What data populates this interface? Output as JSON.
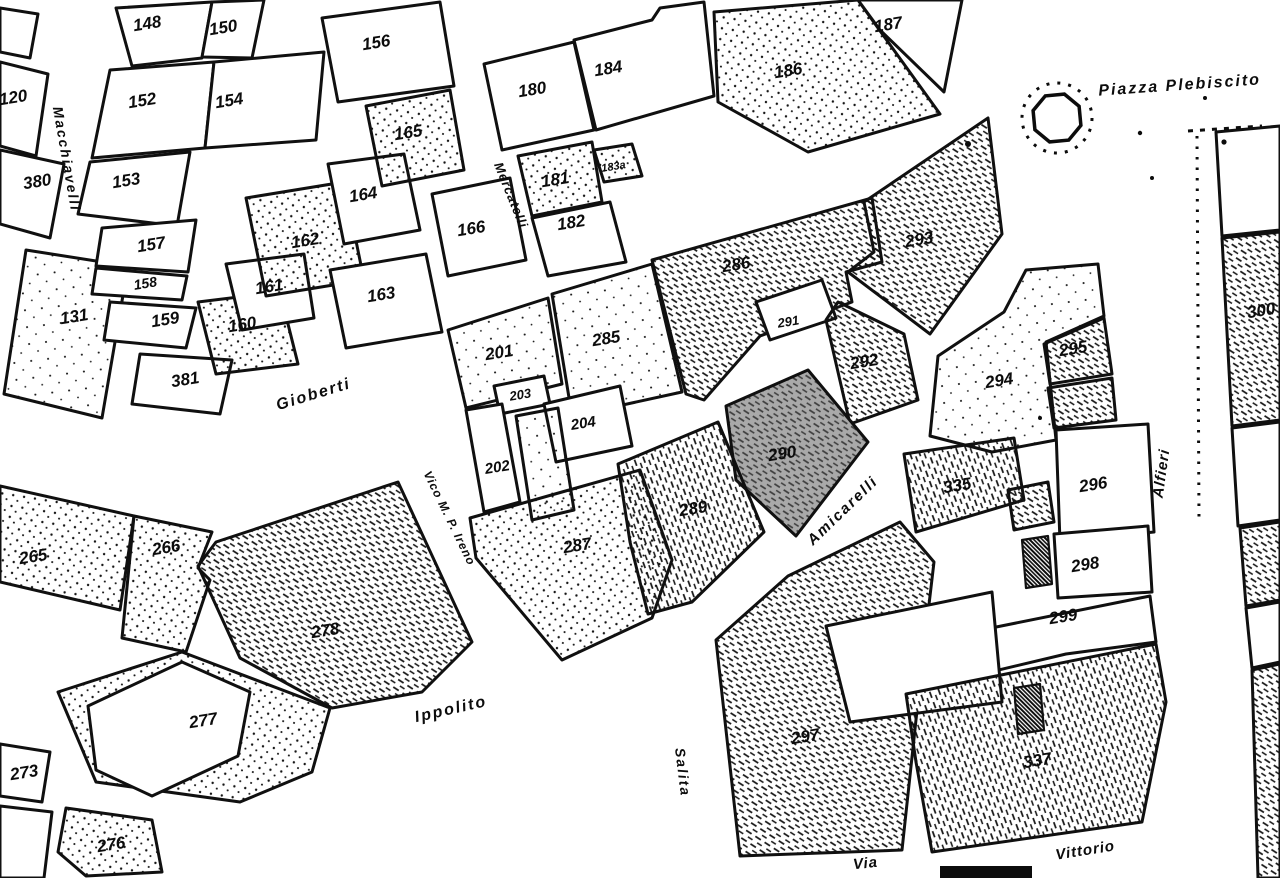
{
  "map": {
    "ink": "#0c0c0c",
    "paper": "#ffffff",
    "highlight_fill": "#a9a9a9",
    "streets": [
      {
        "name": "Macchiavelli",
        "x": 62,
        "y": 160,
        "rotate": 80,
        "size": 14,
        "spacing": 2
      },
      {
        "name": "Mercatelli",
        "x": 507,
        "y": 197,
        "rotate": 68,
        "size": 13,
        "spacing": 1
      },
      {
        "name": "Gioberti",
        "x": 315,
        "y": 399,
        "rotate": -17,
        "size": 16,
        "spacing": 2
      },
      {
        "name": "Vico M. P. Ireno",
        "x": 446,
        "y": 520,
        "rotate": 64,
        "size": 12,
        "spacing": 1
      },
      {
        "name": "Ippolito",
        "x": 452,
        "y": 714,
        "rotate": -13,
        "size": 16,
        "spacing": 2
      },
      {
        "name": "Salita",
        "x": 678,
        "y": 773,
        "rotate": 83,
        "size": 14,
        "spacing": 2
      },
      {
        "name": "Amicarelli",
        "x": 846,
        "y": 514,
        "rotate": -44,
        "size": 15,
        "spacing": 2
      },
      {
        "name": "Alfieri",
        "x": 1166,
        "y": 474,
        "rotate": -82,
        "size": 15,
        "spacing": 1
      },
      {
        "name": "Piazza Plebiscito",
        "x": 1180,
        "y": 90,
        "rotate": -4,
        "size": 16,
        "spacing": 2
      },
      {
        "name": "Via",
        "x": 866,
        "y": 868,
        "rotate": -6,
        "size": 15,
        "spacing": 1
      },
      {
        "name": "Vittorio",
        "x": 1086,
        "y": 855,
        "rotate": -9,
        "size": 15,
        "spacing": 1
      }
    ],
    "parcels": [
      {
        "number": "120",
        "x": 14,
        "y": 103,
        "fill": "white",
        "points": "0,62 48,74 36,156 0,146"
      },
      {
        "number": "380",
        "x": 38,
        "y": 187,
        "fill": "white",
        "points": "0,150 64,164 50,238 0,224"
      },
      {
        "number": "131",
        "x": 75,
        "y": 322,
        "fill": "dots2",
        "points": "26,250 128,266 102,418 4,394"
      },
      {
        "number": "",
        "x": 0,
        "y": 0,
        "fill": "white",
        "points": "0,8 38,14 30,58 0,52"
      },
      {
        "number": "148",
        "x": 148,
        "y": 29,
        "fill": "white",
        "points": "116,8 212,2 202,58 132,66"
      },
      {
        "number": "150",
        "x": 224,
        "y": 33,
        "fill": "white",
        "points": "212,2 264,0 252,58 202,57"
      },
      {
        "number": "152",
        "x": 143,
        "y": 106,
        "fill": "white",
        "points": "110,70 214,62 205,148 92,158"
      },
      {
        "number": "154",
        "x": 230,
        "y": 106,
        "fill": "white",
        "points": "214,62 324,52 316,140 205,148"
      },
      {
        "number": "156",
        "x": 377,
        "y": 48,
        "fill": "white",
        "points": "322,18 440,2 454,86 338,102"
      },
      {
        "number": "153",
        "x": 127,
        "y": 186,
        "fill": "white",
        "points": "90,162 190,152 177,226 78,214"
      },
      {
        "number": "157",
        "x": 152,
        "y": 250,
        "fill": "white",
        "points": "102,228 196,220 188,272 96,266"
      },
      {
        "number": "158",
        "x": 146,
        "y": 288,
        "fill": "white",
        "size": 14,
        "points": "96,268 187,276 182,300 92,294"
      },
      {
        "number": "159",
        "x": 166,
        "y": 325,
        "fill": "white",
        "points": "110,302 196,308 186,348 104,340"
      },
      {
        "number": "381",
        "x": 186,
        "y": 385,
        "fill": "white",
        "points": "140,354 232,360 220,414 132,404"
      },
      {
        "number": "160",
        "x": 243,
        "y": 330,
        "fill": "dots",
        "points": "198,302 280,292 298,364 216,374"
      },
      {
        "number": "161",
        "x": 270,
        "y": 292,
        "fill": "white",
        "points": "226,264 304,254 314,318 242,330"
      },
      {
        "number": "162",
        "x": 306,
        "y": 246,
        "fill": "dots",
        "points": "246,198 344,182 364,280 266,296"
      },
      {
        "number": "163",
        "x": 382,
        "y": 300,
        "fill": "white",
        "points": "330,270 426,254 442,332 346,348"
      },
      {
        "number": "164",
        "x": 364,
        "y": 200,
        "fill": "white",
        "points": "328,164 404,154 420,230 344,244"
      },
      {
        "number": "165",
        "x": 409,
        "y": 138,
        "fill": "dots",
        "points": "366,106 450,90 464,170 382,186"
      },
      {
        "number": "166",
        "x": 472,
        "y": 234,
        "fill": "white",
        "points": "432,194 510,178 526,260 448,276"
      },
      {
        "number": "180",
        "x": 533,
        "y": 95,
        "fill": "white",
        "points": "484,64 574,42 594,130 502,150"
      },
      {
        "number": "184",
        "x": 609,
        "y": 74,
        "fill": "white",
        "points": "574,40 652,20 660,8 704,2 714,96 596,130"
      },
      {
        "number": "186",
        "x": 789,
        "y": 76,
        "fill": "dots",
        "points": "714,12 858,0 878,28 940,114 808,152 718,102"
      },
      {
        "number": "187",
        "x": 889,
        "y": 30,
        "fill": "white",
        "points": "858,0 962,0 944,92 880,30"
      },
      {
        "number": "181",
        "x": 556,
        "y": 185,
        "fill": "dots",
        "points": "518,156 592,142 602,202 532,216"
      },
      {
        "number": "183a",
        "x": 614,
        "y": 170,
        "fill": "dots",
        "size": 11,
        "points": "594,150 632,144 642,176 604,182"
      },
      {
        "number": "182",
        "x": 572,
        "y": 228,
        "fill": "white",
        "points": "532,218 610,202 626,262 548,276"
      },
      {
        "number": "201",
        "x": 500,
        "y": 358,
        "fill": "dots2",
        "points": "448,330 548,298 562,384 466,408"
      },
      {
        "number": "285",
        "x": 607,
        "y": 344,
        "fill": "dots2",
        "points": "552,294 652,264 682,392 572,416"
      },
      {
        "number": "286",
        "x": 737,
        "y": 270,
        "fill": "hatch",
        "points": "652,260 872,198 882,262 846,272 852,302 760,336 704,400 686,394"
      },
      {
        "number": "293",
        "x": 920,
        "y": 245,
        "fill": "hatch",
        "points": "864,202 988,118 1002,234 930,334 848,272 874,252"
      },
      {
        "number": "291",
        "x": 789,
        "y": 326,
        "fill": "white",
        "size": 13,
        "points": "756,302 822,280 836,318 770,340"
      },
      {
        "number": "292",
        "x": 865,
        "y": 367,
        "fill": "hatch",
        "points": "838,302 904,334 918,400 850,424 826,320"
      },
      {
        "number": "290",
        "x": 783,
        "y": 459,
        "fill": "gray",
        "points": "726,406 808,370 868,442 796,536 736,480"
      },
      {
        "number": "203",
        "x": 521,
        "y": 399,
        "fill": "white",
        "size": 13,
        "points": "494,386 544,376 550,404 500,414"
      },
      {
        "number": "204",
        "x": 584,
        "y": 428,
        "fill": "white",
        "size": 15,
        "points": "544,404 620,386 632,446 556,462"
      },
      {
        "number": "202",
        "x": 498,
        "y": 472,
        "fill": "white",
        "size": 15,
        "points": "466,410 502,404 520,502 484,512"
      },
      {
        "number": "",
        "x": 0,
        "y": 0,
        "fill": "dots2",
        "points": "516,416 558,408 574,510 532,520"
      },
      {
        "number": "287",
        "x": 578,
        "y": 551,
        "fill": "dots",
        "points": "470,518 562,492 640,470 672,560 652,618 562,660 476,558"
      },
      {
        "number": "289",
        "x": 694,
        "y": 514,
        "fill": "vhatch",
        "points": "618,464 718,422 764,532 692,602 648,614 630,542"
      },
      {
        "number": "294",
        "x": 1000,
        "y": 386,
        "fill": "dots2",
        "points": "930,436 938,356 1004,312 1026,270 1098,264 1104,316 1046,342 1056,440 992,452"
      },
      {
        "number": "295",
        "x": 1074,
        "y": 354,
        "fill": "hatch",
        "points": "1044,344 1104,318 1112,374 1050,384"
      },
      {
        "number": "",
        "x": 0,
        "y": 0,
        "fill": "hatch",
        "points": "1048,388 1112,378 1116,420 1054,428"
      },
      {
        "number": "335",
        "x": 958,
        "y": 491,
        "fill": "vhatch",
        "points": "904,454 1014,438 1024,500 916,532"
      },
      {
        "number": "296",
        "x": 1094,
        "y": 490,
        "fill": "white",
        "points": "1056,430 1148,424 1154,532 1060,542"
      },
      {
        "number": "",
        "x": 0,
        "y": 0,
        "fill": "hatch",
        "points": "1008,490 1048,482 1054,522 1014,530"
      },
      {
        "number": "298",
        "x": 1086,
        "y": 570,
        "fill": "white",
        "points": "1054,534 1148,526 1152,592 1058,598"
      },
      {
        "number": "299",
        "x": 1064,
        "y": 622,
        "fill": "white",
        "points": "902,646 1150,596 1156,642 1066,654 906,692"
      },
      {
        "number": "297",
        "x": 806,
        "y": 742,
        "fill": "hatch",
        "points": "716,640 788,576 900,522 934,562 922,664 902,850 740,856"
      },
      {
        "number": "",
        "x": 0,
        "y": 0,
        "fill": "white",
        "points": "826,626 992,592 1002,702 850,722"
      },
      {
        "number": "337",
        "x": 1038,
        "y": 766,
        "fill": "vhatch",
        "points": "906,694 1156,644 1166,702 1142,822 932,852 916,762"
      },
      {
        "number": "300",
        "x": 1262,
        "y": 316,
        "fill": "hatch",
        "points": "1222,238 1280,232 1280,420 1232,426"
      },
      {
        "number": "",
        "x": 0,
        "y": 0,
        "fill": "white",
        "points": "1216,132 1280,126 1280,230 1222,236"
      },
      {
        "number": "",
        "x": 0,
        "y": 0,
        "fill": "white",
        "points": "1232,428 1280,422 1280,520 1238,526"
      },
      {
        "number": "",
        "x": 0,
        "y": 0,
        "fill": "hatch",
        "points": "1240,528 1280,522 1280,600 1246,606"
      },
      {
        "number": "",
        "x": 0,
        "y": 0,
        "fill": "white",
        "points": "1246,608 1280,602 1280,662 1252,668"
      },
      {
        "number": "",
        "x": 0,
        "y": 0,
        "fill": "hatch",
        "points": "1252,670 1280,664 1280,878 1258,878"
      },
      {
        "number": "265",
        "x": 34,
        "y": 562,
        "fill": "dots",
        "points": "0,486 134,516 120,610 0,582"
      },
      {
        "number": "266",
        "x": 167,
        "y": 553,
        "fill": "dots",
        "points": "134,516 212,532 198,568 210,580 186,652 122,638"
      },
      {
        "number": "278",
        "x": 326,
        "y": 636,
        "fill": "hatch",
        "points": "216,542 398,482 472,642 422,692 332,708 240,658 198,566"
      },
      {
        "number": "277",
        "x": 204,
        "y": 726,
        "fill": "dots",
        "points": "58,692 182,652 330,708 312,772 240,802 96,782"
      },
      {
        "number": "",
        "x": 0,
        "y": 0,
        "fill": "white",
        "points": "88,706 182,662 250,692 238,756 152,796 96,770"
      },
      {
        "number": "273",
        "x": 25,
        "y": 778,
        "fill": "white",
        "points": "0,744 50,752 42,802 0,796"
      },
      {
        "number": "276",
        "x": 112,
        "y": 850,
        "fill": "dots",
        "points": "66,808 152,820 162,872 86,876 58,852"
      },
      {
        "number": "",
        "x": 0,
        "y": 0,
        "fill": "white",
        "points": "0,806 52,812 44,878 0,878"
      },
      {
        "number": "",
        "x": 0,
        "y": 0,
        "fill": "cross",
        "points": "1022,540 1048,536 1052,584 1026,588"
      },
      {
        "number": "",
        "x": 0,
        "y": 0,
        "fill": "cross",
        "points": "1014,688 1040,684 1044,730 1018,734"
      }
    ],
    "landmarks": [
      {
        "name": "fountain",
        "x": 1057,
        "y": 118,
        "r": 25,
        "ring_r": 35
      }
    ]
  }
}
